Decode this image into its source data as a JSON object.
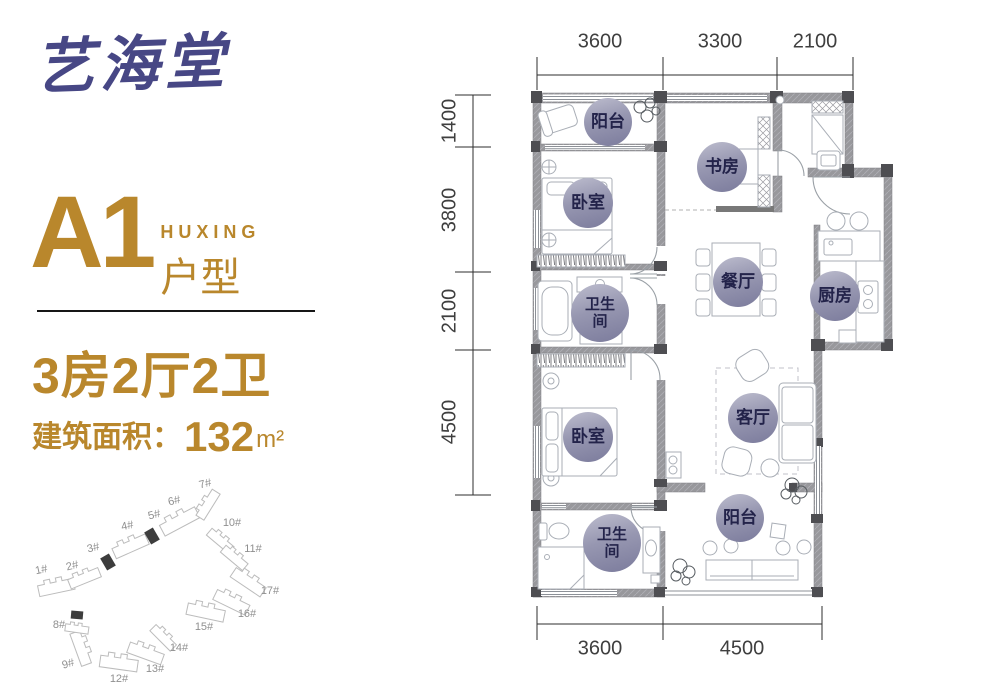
{
  "brand": {
    "logo_text": "艺海堂"
  },
  "unit": {
    "name": "A1",
    "type_en": "HUXING",
    "type_cn": "户型"
  },
  "specs": {
    "layout": "3房2厅2卫",
    "area_label": "建筑面积：",
    "area_value": "132",
    "area_unit": "m²"
  },
  "plan": {
    "dims_top": [
      "3600",
      "3300",
      "2100"
    ],
    "dims_left": [
      "1400",
      "3800",
      "2100",
      "4500"
    ],
    "dims_bottom": [
      "3600",
      "4500"
    ],
    "rooms": [
      {
        "label": "阳台"
      },
      {
        "label": "书房"
      },
      {
        "label": "卧室"
      },
      {
        "label": "卫生间"
      },
      {
        "label": "餐厅"
      },
      {
        "label": "厨房"
      },
      {
        "label": "客厅"
      },
      {
        "label": "卧室"
      },
      {
        "label": "阳台"
      },
      {
        "label": "卫生间"
      }
    ]
  },
  "site_plan": {
    "buildings": [
      {
        "label": "1#"
      },
      {
        "label": "2#"
      },
      {
        "label": "3#"
      },
      {
        "label": "4#"
      },
      {
        "label": "5#"
      },
      {
        "label": "6#"
      },
      {
        "label": "7#"
      },
      {
        "label": "8#"
      },
      {
        "label": "9#"
      },
      {
        "label": "10#"
      },
      {
        "label": "11#"
      },
      {
        "label": "12#"
      },
      {
        "label": "13#"
      },
      {
        "label": "14#"
      },
      {
        "label": "15#"
      },
      {
        "label": "16#"
      },
      {
        "label": "17#"
      }
    ],
    "highlighted_units": [
      "3#",
      "5#",
      "8#"
    ]
  },
  "colors": {
    "accent_gold": "#b9872c",
    "logo_navy": "#474785",
    "wall_gray": "#98989c",
    "highlight_dark": "#3d3d3d",
    "circle_text": "#23234a",
    "dim_text": "#3f3f3f"
  }
}
